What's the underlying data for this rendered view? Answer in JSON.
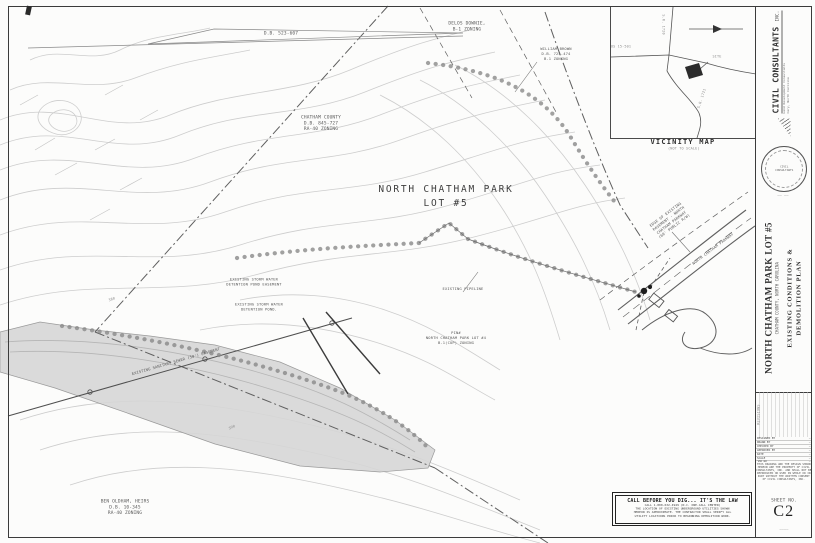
{
  "drawing": {
    "labels": {
      "db_ref": "D.B. 523-607",
      "delos": {
        "l1": "DELOS DOWNIE,",
        "l2": "B-1 ZONING"
      },
      "brown": {
        "l1": "WILLIAM BROWN",
        "l2": "D.B. 725-474",
        "l3": "B-1 ZONING"
      },
      "county": {
        "l1": "CHATHAM COUNTY",
        "l2": "D.B. 845-727",
        "l3": "RA-40 ZONING"
      },
      "lot5": {
        "l1": "NORTH CHATHAM PARK",
        "l2": "LOT #5"
      },
      "pond_easement": {
        "l1": "EXISTING STORM WATER",
        "l2": "DETENTION POND EASEMENT"
      },
      "pond": {
        "l1": "EXISTING STORM WATER",
        "l2": "DETENTION POND."
      },
      "pipeline": "EXISTING PIPELINE",
      "lot4": {
        "l1": "PIN#",
        "l2": "NORTH CHATHAM PARK LOT #4",
        "l3": "B-1(CUP) ZONING"
      },
      "road_note": {
        "l1": "EDGE OF EXISTING",
        "l2": "PAVEMENT - NORTH",
        "l3": "CHATHAM PARKWAY",
        "l4": "(60' PUBLIC R/W)"
      },
      "parkway": "NORTH CHATHAM PARKWAY",
      "oldham": {
        "l1": "BEN OLDHAM, HEIRS",
        "l2": "D.B. 10-345",
        "l3": "RA-40 ZONING"
      },
      "sewer_easement": "EXISTING SANITARY SEWER (50') EASEMENT",
      "contour_a": "380",
      "contour_b": "390"
    }
  },
  "vicinity": {
    "title": "VICINITY MAP",
    "subtitle": "(NOT TO SCALE)",
    "labels": {
      "us_route": "US 15-501",
      "site": "SITE",
      "road_n": "S.R. 1720",
      "road_s": "S.R. 1721"
    }
  },
  "titleblock": {
    "firm": {
      "name": "CIVIL CONSULTANTS",
      "suffix": "INC.",
      "tagline": "Land Development Consultants",
      "address": "Cary, North Carolina"
    },
    "seal": {
      "org": "CIVIL",
      "org2": "CONSULTANTS",
      "number": "—— ——"
    },
    "project": {
      "title": "NORTH CHATHAM PARK LOT #5",
      "location": "CHATHAM COUNTY,  NORTH CAROLINA",
      "plan1": "EXISTING CONDITIONS &",
      "plan2": "DEMOLITION PLAN"
    },
    "revisions_header": "REVISIONS",
    "info_rows": [
      {
        "label": "DESIGNED BY",
        "value": "—"
      },
      {
        "label": "DRAWN BY",
        "value": "—"
      },
      {
        "label": "CHECKED BY",
        "value": "—"
      },
      {
        "label": "APPROVED BY",
        "value": "—"
      },
      {
        "label": "DATE",
        "value": "—"
      },
      {
        "label": "SCALE",
        "value": "—"
      },
      {
        "label": "JOB NO.",
        "value": "—"
      }
    ],
    "note_lines": [
      "THIS DRAWING AND THE DESIGN SHOWN",
      "HEREON ARE THE PROPERTY OF CIVIL",
      "CONSULTANTS, INC. AND SHALL NOT BE",
      "REPRODUCED OR USED IN WHOLE OR IN",
      "PART WITHOUT THE WRITTEN CONSENT",
      "OF CIVIL CONSULTANTS, INC."
    ],
    "sheet": {
      "label": "SHEET NO.",
      "number": "C2",
      "file": "————"
    }
  },
  "callbox": {
    "title": "CALL BEFORE YOU DIG... IT'S THE LAW",
    "lines": [
      "CALL 1-800-632-4949  (N.C. ONE-CALL CENTER)",
      "THE LOCATION OF EXISTING UNDERGROUND UTILITIES SHOWN",
      "HEREON IS APPROXIMATE. THE CONTRACTOR SHALL VERIFY ALL",
      "UTILITY LOCATIONS PRIOR TO BEGINNING DEMOLITION WORK."
    ]
  }
}
